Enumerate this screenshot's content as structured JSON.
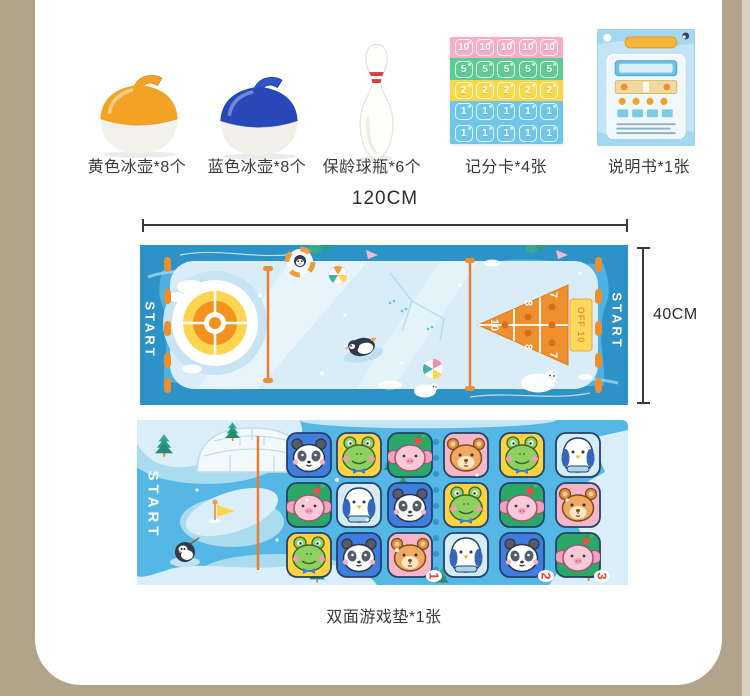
{
  "page": {
    "bg": "#b2a48b",
    "panel_bg": "#ffffff"
  },
  "items": [
    {
      "id": "yellow-curling-stone",
      "label": "黄色冰壶*8个",
      "color": "#f4a224"
    },
    {
      "id": "blue-curling-stone",
      "label": "蓝色冰壶*8个",
      "color": "#2847b8"
    },
    {
      "id": "bowling-pin",
      "label": "保龄球瓶*6个",
      "color": "#ffffff"
    },
    {
      "id": "score-card",
      "label": "记分卡*4张"
    },
    {
      "id": "manual",
      "label": "说明书*1张"
    }
  ],
  "score_card": {
    "columns": 5,
    "rows": [
      {
        "value": "10",
        "bg": "#f6aec6"
      },
      {
        "value": "5",
        "bg": "#5fcb92"
      },
      {
        "value": "2",
        "bg": "#f8d84a"
      },
      {
        "value": "1",
        "bg": "#6fc6e9"
      },
      {
        "value": "1",
        "bg": "#6fc6e9"
      }
    ]
  },
  "dimensions": {
    "width": "120CM",
    "height": "40CM"
  },
  "mat_front": {
    "start_label": "START",
    "start_label_right": "START",
    "zone_scores": [
      "10",
      "8",
      "8",
      "7",
      "7"
    ],
    "off_label": "OFF 10",
    "colors": {
      "water": "#4fb1e1",
      "wave": "#2d92c5",
      "ice": "#d9edf8",
      "accent": "#ee8f2b"
    }
  },
  "mat_back": {
    "start_label": "START",
    "lane_numbers": [
      "1",
      "2",
      "3"
    ],
    "tile_colors": {
      "blue": "#3f7dde",
      "yellow": "#ffd23f",
      "green": "#2aa865",
      "pink": "#f5b7c7",
      "paleblue": "#d6ecf5"
    },
    "tiles": [
      [
        {
          "animal": "panda",
          "bg": "blue"
        },
        {
          "animal": "frog",
          "bg": "yellow"
        },
        {
          "animal": "pig",
          "bg": "green"
        },
        {
          "animal": "bear",
          "bg": "pink"
        },
        {
          "animal": "frog",
          "bg": "yellow"
        },
        {
          "animal": "penguin",
          "bg": "paleblue"
        }
      ],
      [
        {
          "animal": "pig",
          "bg": "green"
        },
        {
          "animal": "penguin",
          "bg": "paleblue"
        },
        {
          "animal": "panda",
          "bg": "blue"
        },
        {
          "animal": "frog",
          "bg": "yellow"
        },
        {
          "animal": "pig",
          "bg": "green"
        },
        {
          "animal": "bear",
          "bg": "pink"
        }
      ],
      [
        {
          "animal": "frog",
          "bg": "yellow"
        },
        {
          "animal": "panda",
          "bg": "blue"
        },
        {
          "animal": "bear",
          "bg": "pink"
        },
        {
          "animal": "penguin",
          "bg": "paleblue"
        },
        {
          "animal": "panda",
          "bg": "blue"
        },
        {
          "animal": "pig",
          "bg": "green"
        }
      ]
    ]
  },
  "caption": "双面游戏垫*1张"
}
